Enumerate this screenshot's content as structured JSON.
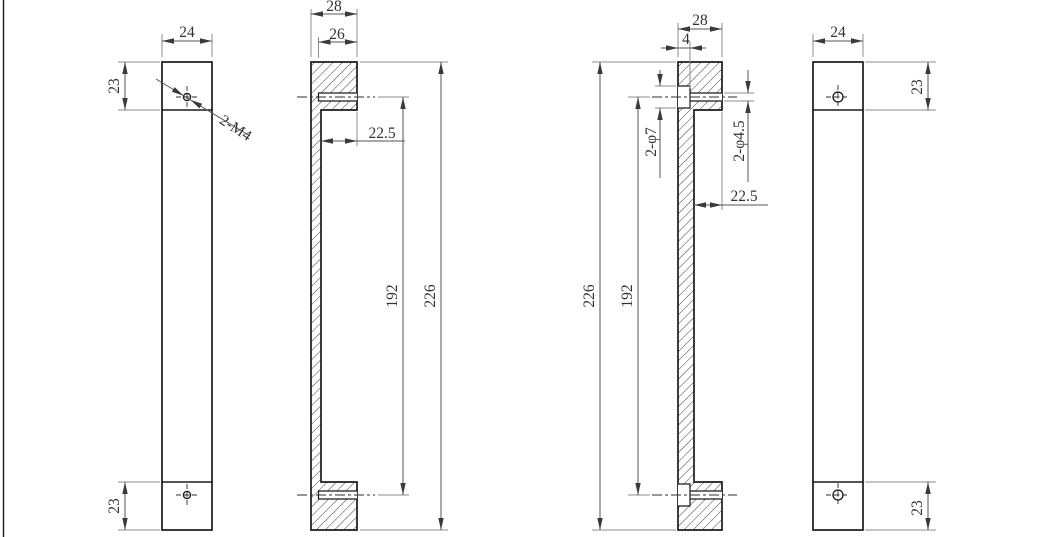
{
  "colors": {
    "background": "#ffffff",
    "object_line": "#1b1b1b",
    "dimension_line": "#565656",
    "extension_line": "#8c8c8c",
    "text": "#333333"
  },
  "views": {
    "front_left": {
      "dims": {
        "width": "24",
        "top": "23",
        "bottom": "23"
      },
      "thread_callout": "2-M4"
    },
    "section_handle": {
      "dims": {
        "width": "28",
        "hole_depth": "26",
        "boss_length": "22.5",
        "hole_spacing": "192",
        "overall": "226"
      }
    },
    "section_plate": {
      "dims": {
        "width": "28",
        "counterbore_depth": "4",
        "counterbore_dia": "2-φ7",
        "through_hole_dia": "2-φ4.5",
        "boss_length": "22.5",
        "hole_spacing": "192",
        "overall": "226"
      }
    },
    "front_right": {
      "dims": {
        "width": "24",
        "top": "23",
        "bottom": "23"
      }
    }
  }
}
